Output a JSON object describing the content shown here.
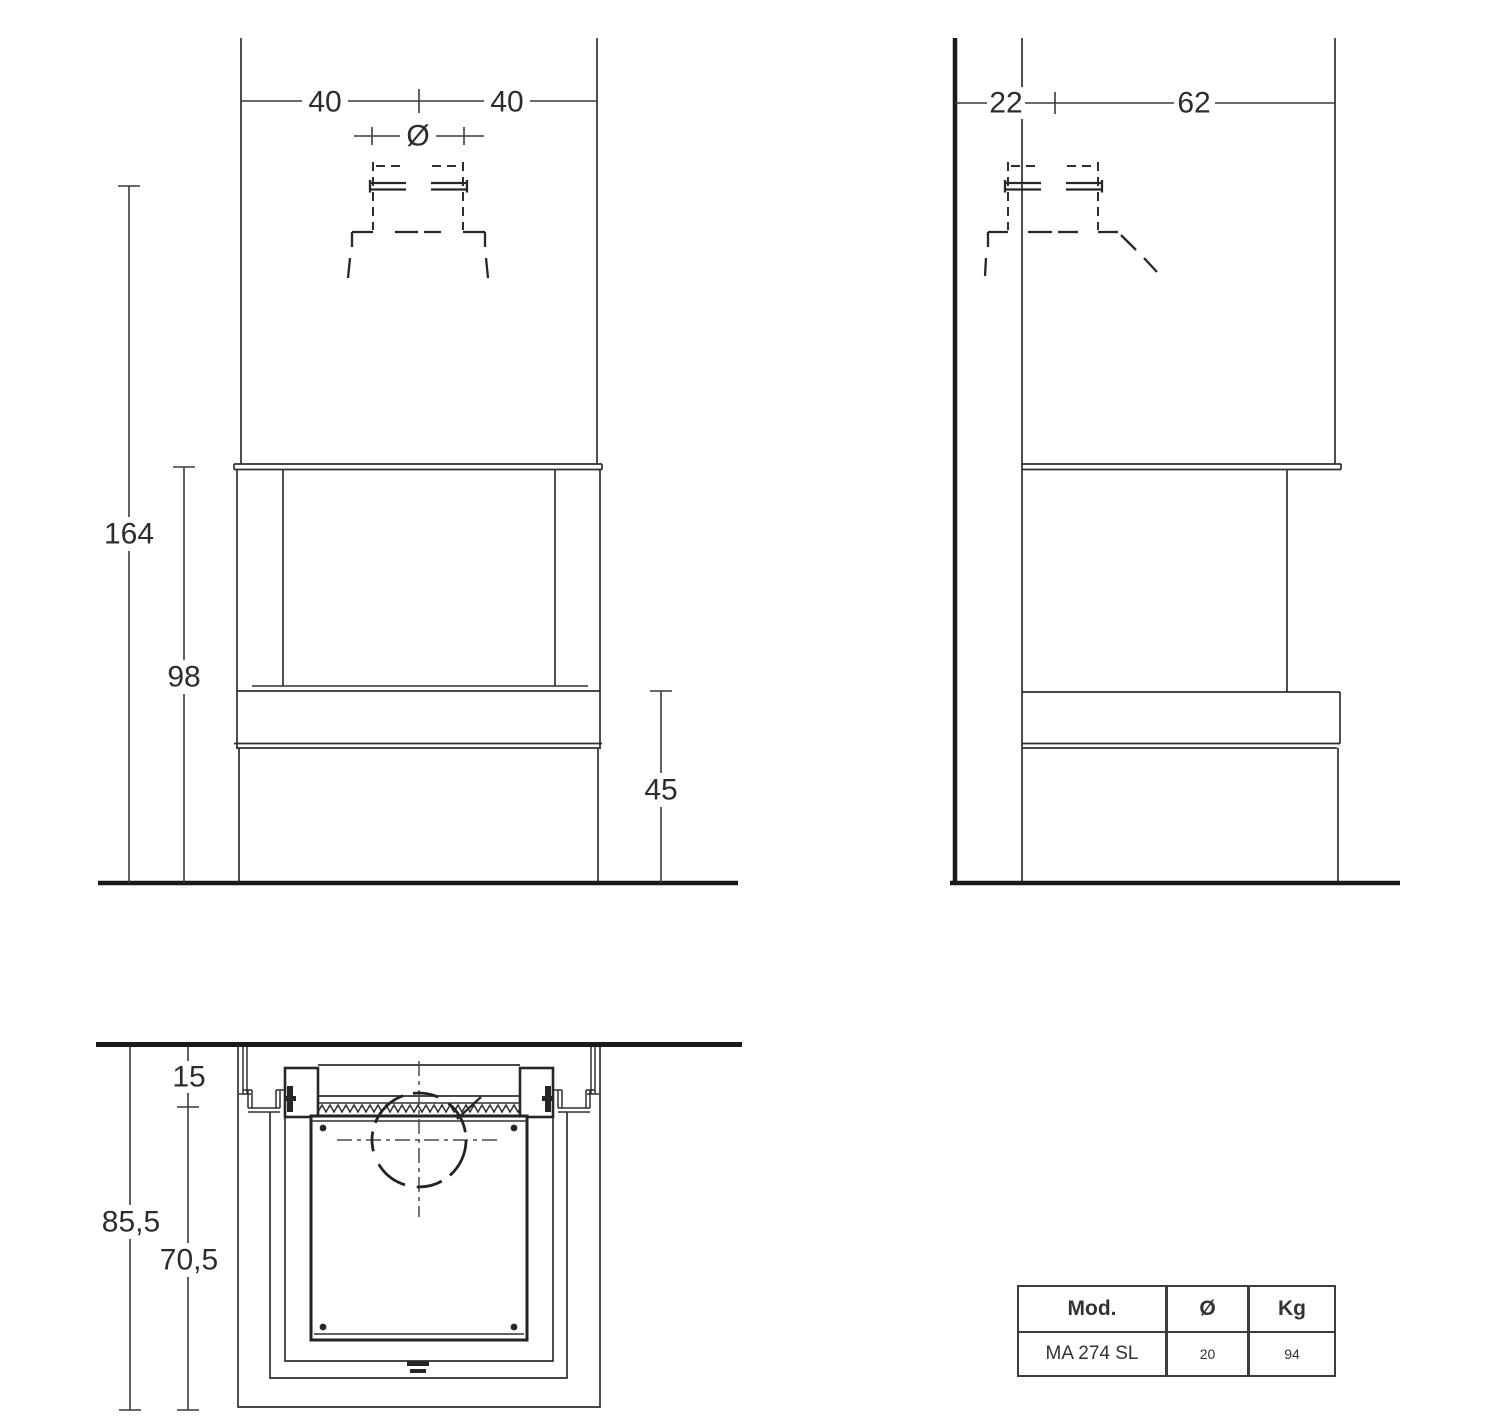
{
  "drawing": {
    "front_view": {
      "width_left": "40",
      "width_right": "40",
      "flue_symbol": "Ø",
      "height_total": "164",
      "height_opening": "98",
      "height_bench": "45"
    },
    "side_view": {
      "wall_gap": "22",
      "depth": "62"
    },
    "plan_view": {
      "wall_clearance": "15",
      "depth_total": "85,5",
      "depth_inner": "70,5"
    },
    "spec_table": {
      "header_model": "Mod.",
      "header_diameter": "Ø",
      "header_weight": "Kg",
      "model": "MA 274 SL",
      "diameter": "20",
      "weight": "94"
    }
  }
}
